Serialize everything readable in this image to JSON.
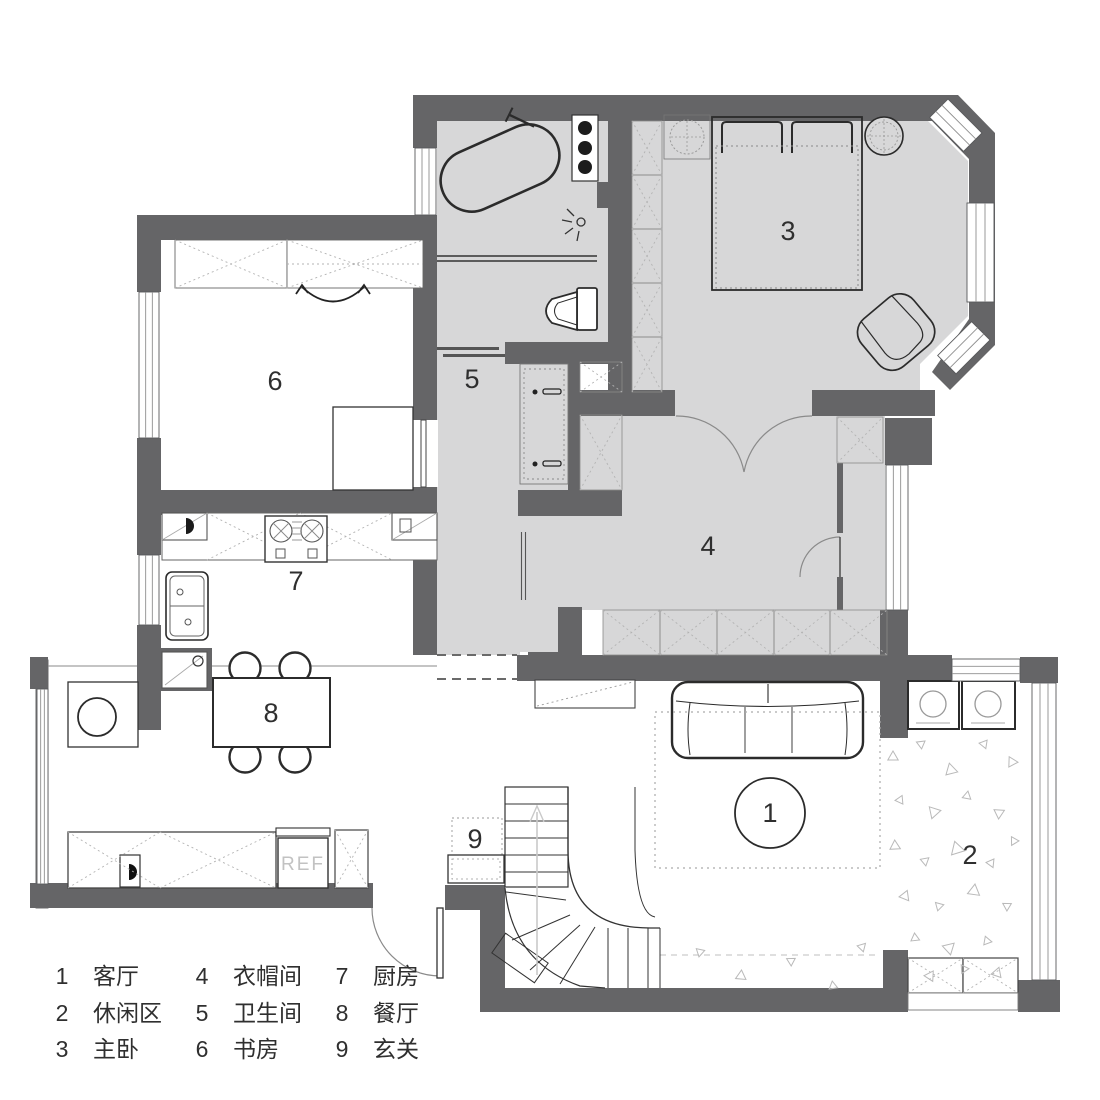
{
  "meta": {
    "type": "apartment-floor-plan",
    "language": "zh"
  },
  "colors": {
    "wall": "#656567",
    "room_shade": "#d7d7d8",
    "paper": "#ffffff",
    "furniture_line": "#2b2b2b"
  },
  "rooms": [
    {
      "num": "1",
      "name": "客厅"
    },
    {
      "num": "2",
      "name": "休闲区"
    },
    {
      "num": "3",
      "name": "主卧"
    },
    {
      "num": "4",
      "name": "衣帽间"
    },
    {
      "num": "5",
      "name": "卫生间"
    },
    {
      "num": "6",
      "name": "书房"
    },
    {
      "num": "7",
      "name": "厨房"
    },
    {
      "num": "8",
      "name": "餐厅"
    },
    {
      "num": "9",
      "name": "玄关"
    }
  ],
  "labels": {
    "fridge": "REF"
  }
}
